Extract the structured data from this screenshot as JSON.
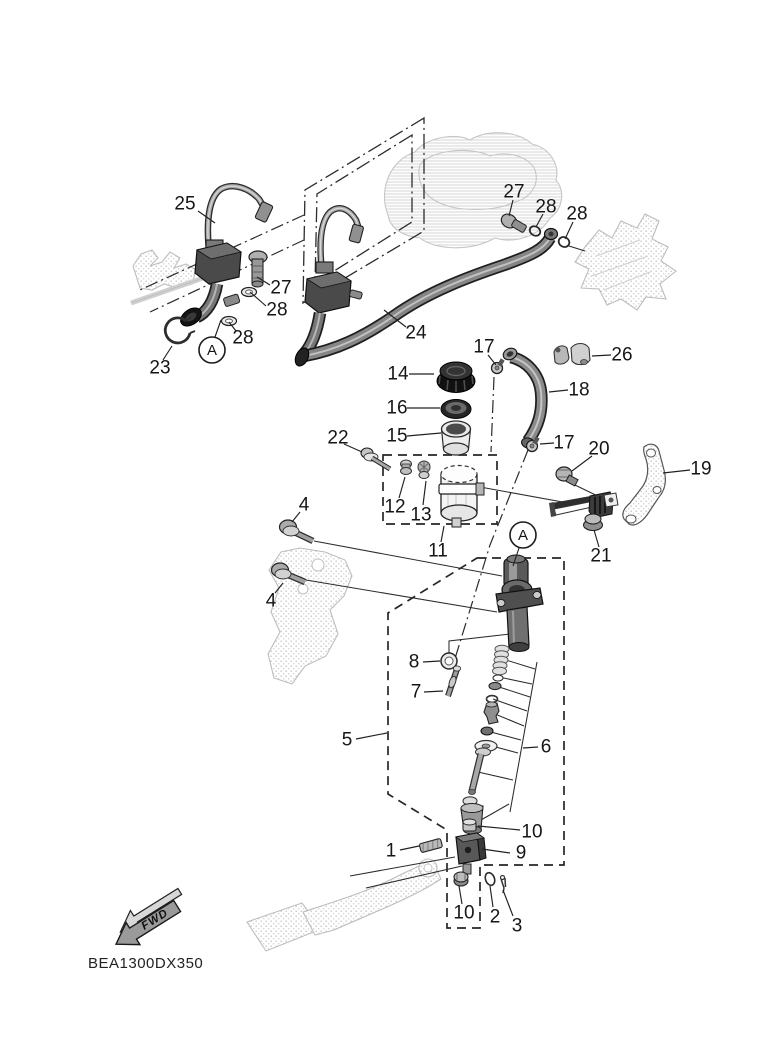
{
  "figure": {
    "code": "BEA1300DX350",
    "fwd_label": "FWD"
  },
  "callouts": [
    {
      "label": "25",
      "x": 185,
      "y": 204,
      "lead": [
        [
          198,
          211
        ],
        [
          215,
          223
        ]
      ]
    },
    {
      "label": "27",
      "x": 281,
      "y": 288,
      "lead": [
        [
          270,
          285
        ],
        [
          257,
          277
        ]
      ]
    },
    {
      "label": "28",
      "x": 277,
      "y": 310,
      "lead": [
        [
          266,
          306
        ],
        [
          250,
          292
        ]
      ]
    },
    {
      "label": "28",
      "x": 243,
      "y": 338,
      "lead": [
        [
          236,
          331
        ],
        [
          229,
          322
        ]
      ]
    },
    {
      "label": "23",
      "x": 160,
      "y": 368,
      "lead": [
        [
          163,
          360
        ],
        [
          172,
          346
        ]
      ]
    },
    {
      "label": "24",
      "x": 416,
      "y": 333,
      "lead": [
        [
          406,
          327
        ],
        [
          384,
          310
        ]
      ]
    },
    {
      "label": "27",
      "x": 514,
      "y": 192,
      "lead": [
        [
          513,
          200
        ],
        [
          509,
          216
        ]
      ]
    },
    {
      "label": "28",
      "x": 546,
      "y": 207,
      "lead": [
        [
          543,
          214
        ],
        [
          536,
          227
        ]
      ]
    },
    {
      "label": "28",
      "x": 577,
      "y": 214,
      "lead": [
        [
          573,
          222
        ],
        [
          565,
          239
        ]
      ]
    },
    {
      "label": "17",
      "x": 484,
      "y": 347,
      "lead": [
        [
          488,
          355
        ],
        [
          496,
          365
        ]
      ]
    },
    {
      "label": "26",
      "x": 622,
      "y": 355,
      "lead": [
        [
          611,
          355
        ],
        [
          592,
          356
        ]
      ]
    },
    {
      "label": "14",
      "x": 398,
      "y": 374,
      "lead": [
        [
          409,
          374
        ],
        [
          434,
          374
        ]
      ]
    },
    {
      "label": "18",
      "x": 579,
      "y": 390,
      "lead": [
        [
          568,
          390
        ],
        [
          549,
          392
        ]
      ]
    },
    {
      "label": "16",
      "x": 397,
      "y": 408,
      "lead": [
        [
          407,
          408
        ],
        [
          440,
          408
        ]
      ]
    },
    {
      "label": "15",
      "x": 397,
      "y": 436,
      "lead": [
        [
          407,
          436
        ],
        [
          441,
          433
        ]
      ]
    },
    {
      "label": "22",
      "x": 338,
      "y": 438,
      "lead": [
        [
          344,
          444
        ],
        [
          362,
          452
        ]
      ]
    },
    {
      "label": "17",
      "x": 564,
      "y": 443,
      "lead": [
        [
          554,
          443
        ],
        [
          540,
          444
        ]
      ]
    },
    {
      "label": "20",
      "x": 599,
      "y": 449,
      "lead": [
        [
          592,
          456
        ],
        [
          572,
          471
        ]
      ]
    },
    {
      "label": "19",
      "x": 701,
      "y": 469,
      "lead": [
        [
          690,
          470
        ],
        [
          663,
          473
        ]
      ]
    },
    {
      "label": "12",
      "x": 395,
      "y": 507,
      "lead": [
        [
          399,
          498
        ],
        [
          405,
          477
        ]
      ]
    },
    {
      "label": "13",
      "x": 421,
      "y": 515,
      "lead": [
        [
          423,
          505
        ],
        [
          426,
          481
        ]
      ]
    },
    {
      "label": "11",
      "x": 438,
      "y": 551,
      "lead": [
        [
          441,
          542
        ],
        [
          444,
          526
        ]
      ]
    },
    {
      "label": "21",
      "x": 601,
      "y": 556,
      "lead": [
        [
          599,
          547
        ],
        [
          594,
          530
        ]
      ]
    },
    {
      "label": "4",
      "x": 304,
      "y": 505,
      "lead": [
        [
          300,
          512
        ],
        [
          292,
          522
        ]
      ]
    },
    {
      "label": "4",
      "x": 271,
      "y": 601,
      "lead": [
        [
          275,
          593
        ],
        [
          283,
          583
        ]
      ]
    },
    {
      "label": "8",
      "x": 414,
      "y": 662,
      "lead": [
        [
          423,
          662
        ],
        [
          440,
          661
        ]
      ]
    },
    {
      "label": "7",
      "x": 416,
      "y": 692,
      "lead": [
        [
          424,
          692
        ],
        [
          443,
          691
        ]
      ]
    },
    {
      "label": "5",
      "x": 347,
      "y": 740,
      "lead": [
        [
          356,
          739
        ],
        [
          387,
          733
        ]
      ]
    },
    {
      "label": "6",
      "x": 546,
      "y": 747,
      "lead": [
        [
          538,
          747
        ],
        [
          523,
          748
        ]
      ]
    },
    {
      "label": "10",
      "x": 532,
      "y": 832,
      "lead": [
        [
          520,
          830
        ],
        [
          478,
          826
        ]
      ]
    },
    {
      "label": "1",
      "x": 391,
      "y": 851,
      "lead": [
        [
          400,
          850
        ],
        [
          419,
          846
        ]
      ]
    },
    {
      "label": "9",
      "x": 521,
      "y": 853,
      "lead": [
        [
          510,
          853
        ],
        [
          482,
          849
        ]
      ]
    },
    {
      "label": "10",
      "x": 464,
      "y": 913,
      "lead": [
        [
          462,
          904
        ],
        [
          459,
          886
        ]
      ]
    },
    {
      "label": "2",
      "x": 495,
      "y": 917,
      "lead": [
        [
          493,
          907
        ],
        [
          490,
          886
        ]
      ]
    },
    {
      "label": "3",
      "x": 517,
      "y": 926,
      "lead": [
        [
          513,
          916
        ],
        [
          503,
          890
        ]
      ]
    }
  ],
  "markers": [
    {
      "label": "A",
      "x": 212,
      "y": 350,
      "r": 13,
      "lead": [
        [
          215,
          337
        ],
        [
          221,
          320
        ]
      ]
    },
    {
      "label": "A",
      "x": 523,
      "y": 535,
      "r": 13,
      "lead": [
        [
          519,
          548
        ],
        [
          513,
          566
        ]
      ]
    }
  ],
  "assembly_lines": [
    {
      "style": "solid",
      "points": [
        [
          314,
          541
        ],
        [
          502,
          576
        ]
      ]
    },
    {
      "style": "solid",
      "points": [
        [
          306,
          580
        ],
        [
          497,
          612
        ]
      ]
    },
    {
      "style": "solid",
      "points": [
        [
          480,
          487
        ],
        [
          590,
          507
        ]
      ]
    },
    {
      "style": "solid",
      "points": [
        [
          575,
          485
        ],
        [
          610,
          502
        ]
      ]
    },
    {
      "style": "solid",
      "points": [
        [
          455,
          857
        ],
        [
          350,
          876
        ]
      ]
    },
    {
      "style": "solid",
      "points": [
        [
          462,
          866
        ],
        [
          366,
          888
        ]
      ]
    },
    {
      "style": "solid",
      "points": [
        [
          449,
          655
        ],
        [
          449,
          641
        ],
        [
          510,
          634
        ]
      ]
    },
    {
      "style": "solid",
      "points": [
        [
          569,
          246
        ],
        [
          585,
          251
        ]
      ]
    },
    {
      "style": "solid",
      "points": [
        [
          537,
          662
        ],
        [
          510,
          812
        ]
      ]
    },
    {
      "style": "solid",
      "points": [
        [
          506,
          660
        ],
        [
          535,
          669
        ]
      ]
    },
    {
      "style": "solid",
      "points": [
        [
          499,
          677
        ],
        [
          532,
          684
        ]
      ]
    },
    {
      "style": "solid",
      "points": [
        [
          496,
          686
        ],
        [
          530,
          697
        ]
      ]
    },
    {
      "style": "solid",
      "points": [
        [
          493,
          699
        ],
        [
          527,
          711
        ]
      ]
    },
    {
      "style": "solid",
      "points": [
        [
          495,
          714
        ],
        [
          524,
          726
        ]
      ]
    },
    {
      "style": "solid",
      "points": [
        [
          487,
          731
        ],
        [
          521,
          740
        ]
      ]
    },
    {
      "style": "solid",
      "points": [
        [
          492,
          746
        ],
        [
          518,
          753
        ]
      ]
    },
    {
      "style": "solid",
      "points": [
        [
          478,
          772
        ],
        [
          513,
          780
        ]
      ]
    },
    {
      "style": "solid",
      "points": [
        [
          481,
          820
        ],
        [
          509,
          804
        ]
      ]
    },
    {
      "style": "dashdot",
      "points": [
        [
          528,
          450
        ],
        [
          490,
          545
        ],
        [
          453,
          665
        ]
      ]
    },
    {
      "style": "dashdot",
      "points": [
        [
          494,
          377
        ],
        [
          491,
          452
        ]
      ]
    },
    {
      "style": "dashdot",
      "points": [
        [
          304,
          215
        ],
        [
          140,
          290
        ]
      ]
    },
    {
      "style": "dashdot",
      "points": [
        [
          304,
          240
        ],
        [
          150,
          312
        ]
      ]
    }
  ],
  "colors": {
    "line": "#1a1a1a",
    "ghost": "#c6c6c6",
    "part_dark": "#3f3f3f",
    "part_mid": "#8a8a8a",
    "part_light": "#d9d9d9",
    "background": "#ffffff"
  }
}
